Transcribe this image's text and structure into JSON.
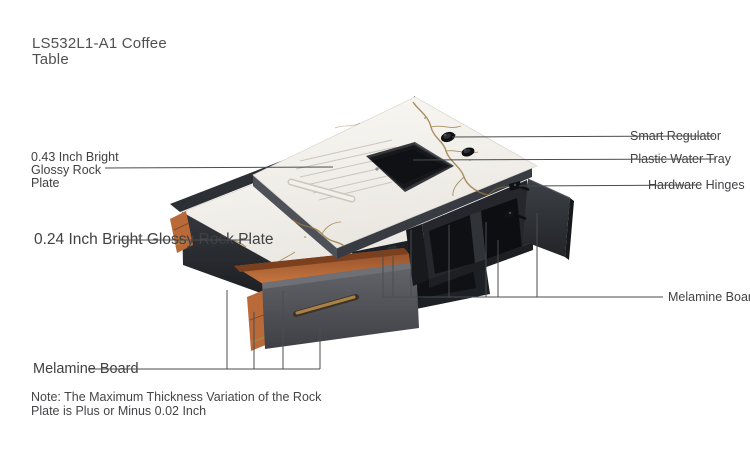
{
  "title": {
    "text": "LS532L1-A1 Coffee Table"
  },
  "labels": {
    "rock_plate_thick": "0.43 Inch Bright Glossy Rock Plate",
    "rock_plate_thin": "0.24 Inch Bright Glossy Rock Plate",
    "melamine_left": "Melamine Board",
    "melamine_right": "Melamine Board",
    "smart_regulator": "Smart Regulator",
    "plastic_water_tray": "Plastic Water Tray",
    "hardware_hinges": "Hardware Hinges"
  },
  "note": {
    "text": "Note: The Maximum Thickness Variation of the Rock Plate is Plus or Minus 0.02 Inch"
  },
  "colors": {
    "background": "#ffffff",
    "title_text": "#505053",
    "label_text": "#414144",
    "note_text": "#454548",
    "leader_line": "#4a4c4e",
    "marble": "#f6f4f0",
    "marble_vein": "#96763f",
    "cabinet": "#25272c",
    "cabinet_interior": "#0d0f12",
    "door": "#34373d",
    "drawer_front": "#55575c",
    "drawer_orange": "#b96a38",
    "brass": "#ab8144",
    "tray": "#17181b",
    "lower_box": "#2b2e33"
  }
}
